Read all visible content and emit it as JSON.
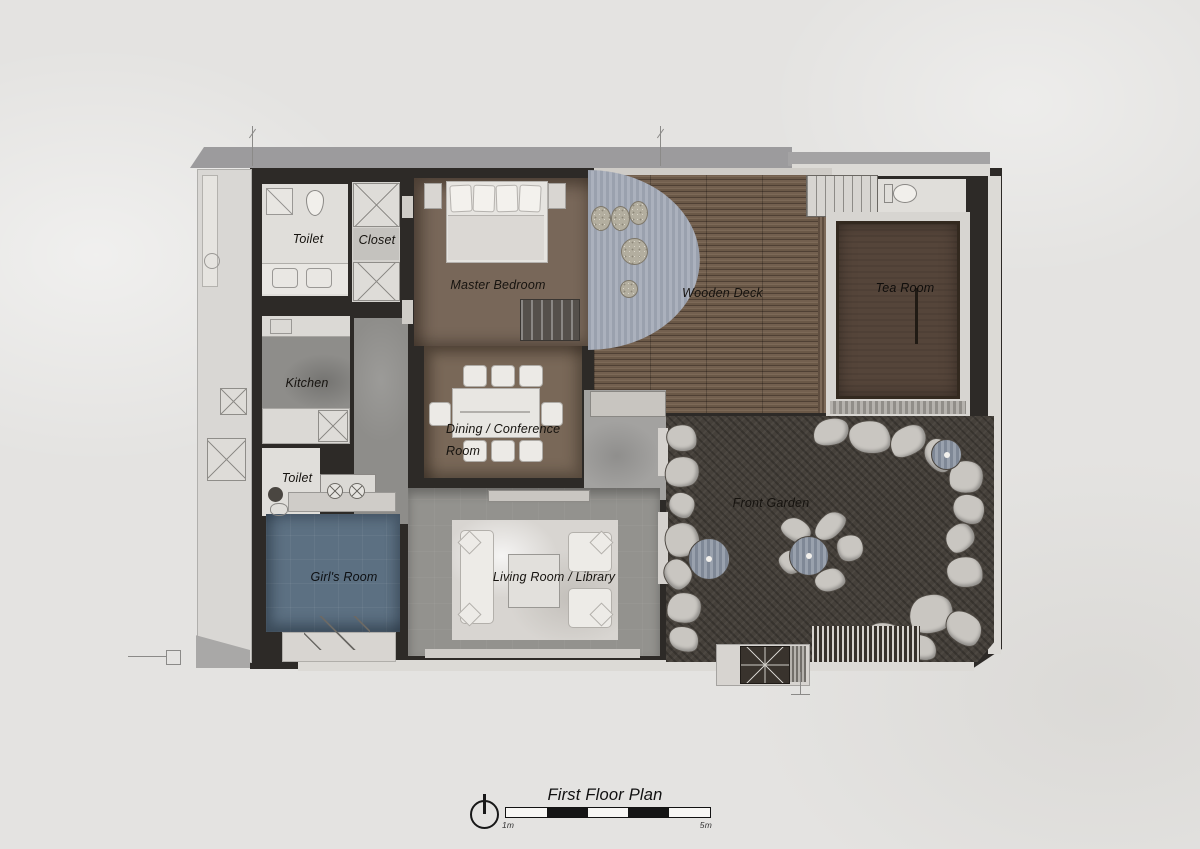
{
  "document": {
    "type": "architectural-first-floor-plan",
    "title": "First Floor Plan",
    "scale_bar": {
      "start_label": "1m",
      "end_label": "5m"
    },
    "north_arrow": "north-arrow-icon"
  },
  "rooms": {
    "toilet_upper": {
      "label": "Toilet"
    },
    "closet": {
      "label": "Closet"
    },
    "master_bedroom": {
      "label": "Master Bedroom"
    },
    "wooden_deck": {
      "label": "Wooden Deck"
    },
    "tea_room": {
      "label": "Tea Room"
    },
    "kitchen": {
      "label": "Kitchen"
    },
    "dining_conference": {
      "label": "Dining / Conference Room"
    },
    "toilet_lower": {
      "label": "Toilet"
    },
    "girls_room": {
      "label": "Girl's Room"
    },
    "living_room_library": {
      "label": "Living Room / Library"
    },
    "front_garden": {
      "label": "Front Garden"
    }
  },
  "palette": {
    "paper": "#e4e3e1",
    "roof_band": "#9c9b9d",
    "wall_dark": "#2d2a27",
    "light_room": "#e0deda",
    "wood_brown": "#786759",
    "deck_plank": "#6b5a4a",
    "tea_room_floor": "#55453a",
    "grey_floor": "#8e8d8a",
    "living_grey": "#93928e",
    "marble_rug": "#d8d5d1",
    "girls_room_blue": "#5c7082",
    "garden_dark": "#45403a",
    "rock_grey": "#c9c6c1",
    "tree_stripe": "#8b93a1",
    "awning_stripe": "#a0a7b4",
    "ink": "#151515"
  }
}
